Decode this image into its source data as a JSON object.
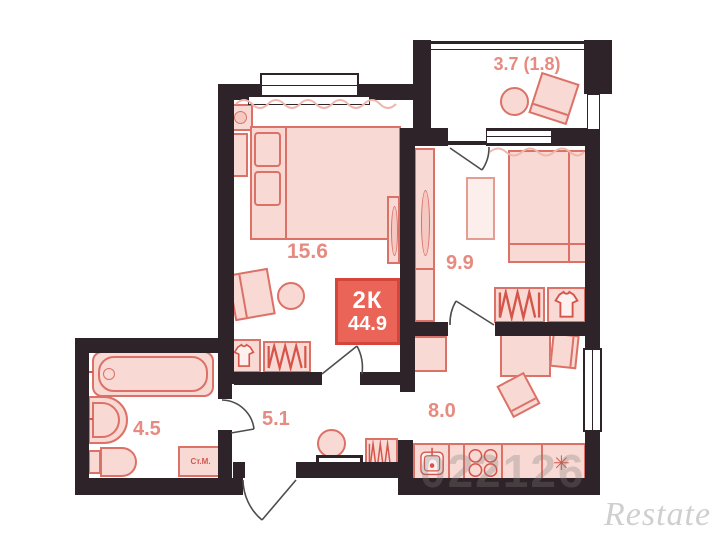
{
  "plan": {
    "badge": {
      "rooms": "2К",
      "area": "44.9"
    },
    "rooms": {
      "balcony": {
        "area": "3.7 (1.8)"
      },
      "bedroom": {
        "area": "15.6"
      },
      "living": {
        "area": "9.9"
      },
      "bathroom": {
        "area": "4.5"
      },
      "hallway": {
        "area": "5.1"
      },
      "kitchen": {
        "area": "8.0"
      }
    },
    "appliances": {
      "washing_machine": "Ст.М."
    },
    "watermark": {
      "brand": "Restate",
      "digits": "022126"
    }
  },
  "icons": {
    "snowflake": "✳"
  },
  "colors": {
    "wall": "#2e2328",
    "furniture_fill": "#f8d9d3",
    "furniture_stroke": "#dc7168",
    "label": "#e78a80",
    "badge_bg": "#ea6557",
    "badge_border": "#d5453a",
    "watermark": "#cfcfcf"
  }
}
